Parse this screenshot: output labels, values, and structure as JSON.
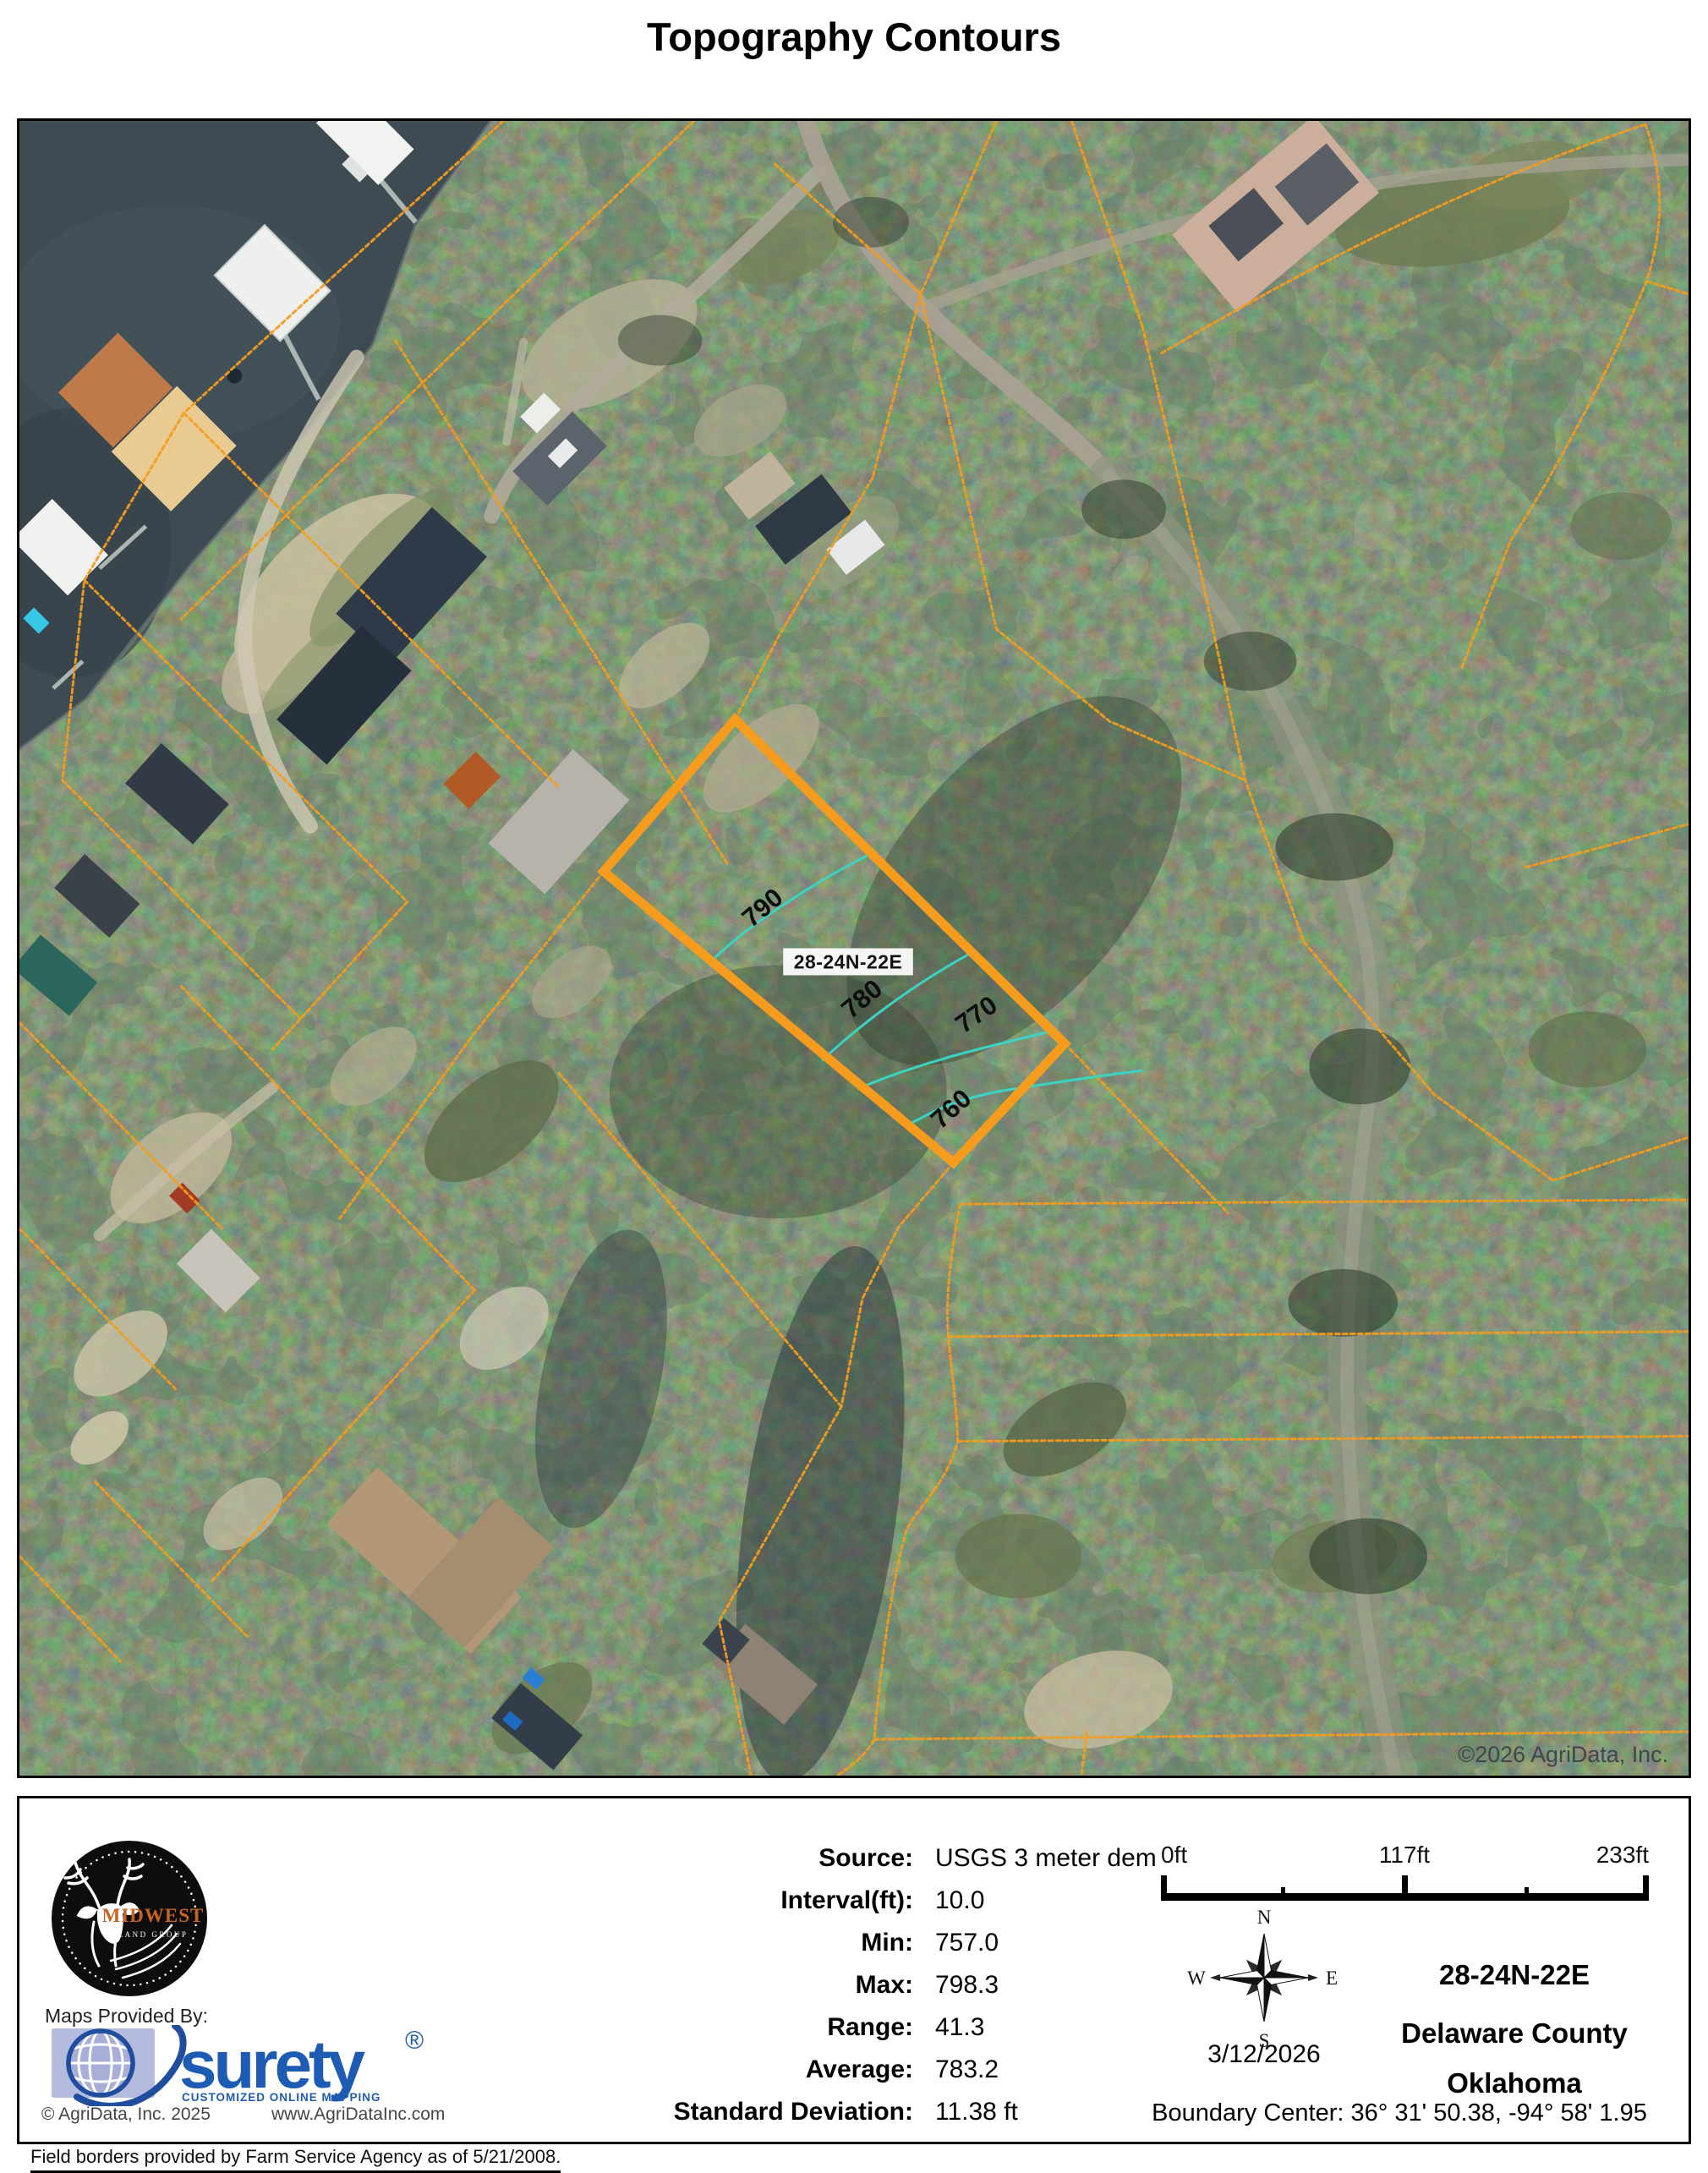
{
  "title": "Topography Contours",
  "colors": {
    "parcel-orange": "#F59C1E",
    "contour-cyan": "#3BD3C3",
    "surety-blue": "#1E5CB3",
    "surety-tile": "#B5BADF",
    "midwest-orange": "#C8631F",
    "water": "#3E4B53"
  },
  "map": {
    "parcel_label": "28-24N-22E",
    "contours": {
      "c790": "790",
      "c780": "780",
      "c770": "770",
      "c760": "760"
    },
    "watermark": "©2026 AgriData, Inc."
  },
  "footer": {
    "stats": {
      "rows": [
        {
          "label": "Source:",
          "value": "USGS 3 meter dem"
        },
        {
          "label": "Interval(ft):",
          "value": "10.0"
        },
        {
          "label": "Min:",
          "value": "757.0"
        },
        {
          "label": "Max:",
          "value": "798.3"
        },
        {
          "label": "Range:",
          "value": "41.3"
        },
        {
          "label": "Average:",
          "value": "783.2"
        },
        {
          "label": "Standard Deviation:",
          "value": "11.38 ft"
        }
      ]
    },
    "scalebar": {
      "t0": "0ft",
      "t1": "117ft",
      "t2": "233ft"
    },
    "compass": {
      "n": "N",
      "e": "E",
      "s": "S",
      "w": "W"
    },
    "date": "3/12/2026",
    "location": {
      "trs": "28-24N-22E",
      "county": "Delaware County",
      "state": "Oklahoma"
    },
    "boundary_center": "Boundary Center: 36° 31' 50.38,  -94° 58' 1.95",
    "provider": {
      "maps_provided_by": "Maps Provided By:",
      "brand": "surety",
      "reg": "®",
      "tagline": "CUSTOMIZED ONLINE MAPPING",
      "copyright": "© AgriData, Inc. 2025",
      "url": "www.AgriDataInc.com"
    },
    "field_note": "Field borders provided by Farm Service Agency as of 5/21/2008.",
    "logo": {
      "name": "MIDWEST",
      "sub": "LAND GROUP"
    }
  }
}
